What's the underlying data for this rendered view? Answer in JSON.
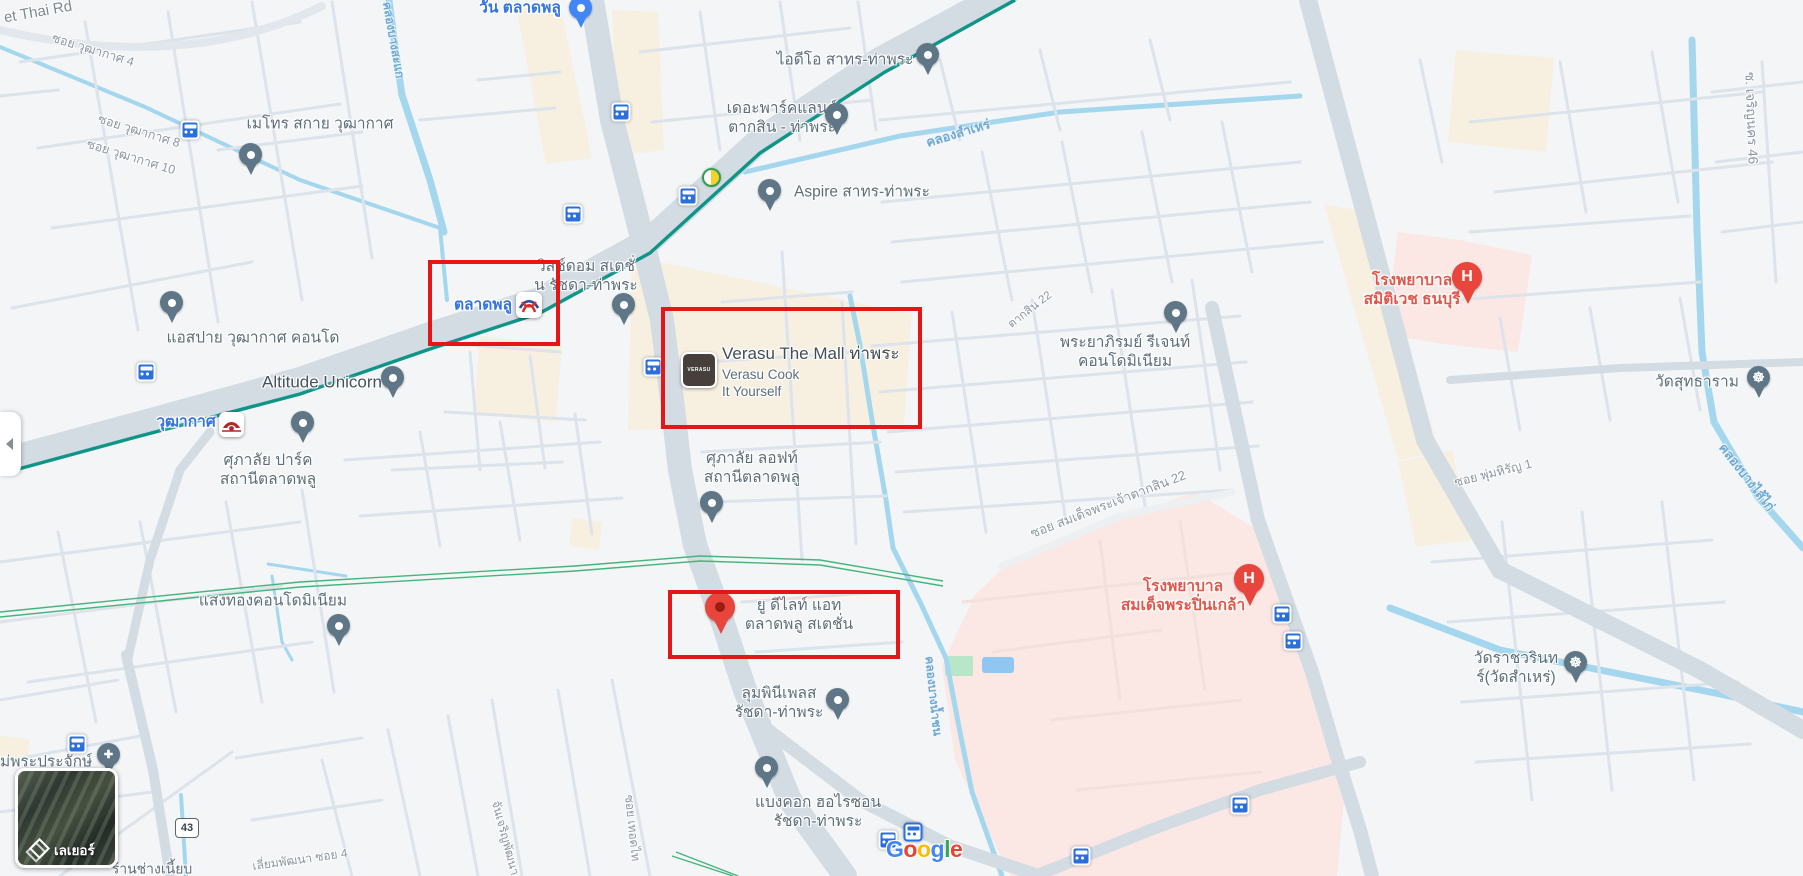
{
  "map": {
    "attribution": {
      "letters": [
        "G",
        "o",
        "o",
        "g",
        "l",
        "e"
      ]
    },
    "layers_panel": {
      "label": "เลเยอร์"
    },
    "route_shield": "43",
    "highlighted_areas": [
      "ตลาดพลู",
      "Verasu The Mall ท่าพระ",
      "ยู ดีไลท์ แอท ตลาดพลู สเตชั่น"
    ],
    "colors": {
      "transit_line": "#0f9488",
      "water": "#a4d7ee",
      "hospital_area": "#fbe7e4",
      "commercial_area": "#f7f0e1",
      "poi_blue": "#3473e0",
      "poi_red": "#e0574a",
      "annotation": "#e51616"
    }
  },
  "streets": {
    "thoet_thai": "et Thai Rd",
    "wutthakat4": "ซอย วุฒากาศ 4",
    "wutthakat8": "ซอย วุฒากาศ 8",
    "wutthakat10": "ซอย วุฒากาศ 10",
    "taksin22": "ตากสิน 22",
    "somdet_taksin22": "ซอย สมเด็จพระเจ้าตากสิน 22",
    "phum_hirun1": "ซอย พุ่มหิรัญ 1",
    "charoen_nakhon46": "ซ. เจริญนคร 46",
    "liam_phatthana": "เลี่ยมพัฒนา ซอย 4",
    "chan_charoen": "จันเจริญพัฒนา",
    "thoet_thai_soi": "ซอย เทอดไท"
  },
  "canals": {
    "samre": "คลองสำเหร่",
    "bang_sai_kai": "คลองบางไส้ไก่",
    "bang_sakae": "คลองบางสะแก",
    "bang_nam_chon": "คลองบางน้ำชน"
  },
  "pois": {
    "talat_phlu_station": "ตลาดพลู",
    "one_talat_phlu": "วัน ตลาดพลู",
    "wutthakat_station": "วุฒากาศ",
    "metro_sky": "เมโทร สกาย วุฒากาศ",
    "ideo": "ไอดีโอ สาทร-ท่าพระ",
    "parkland": "เดอะพาร์คแลนด์\nตากสิน - ท่าพระ",
    "aspire": "Aspire สาทร-ท่าพระ",
    "whizdom": "วิสซ์ดอม สเตชั่\nน รัชดา-ท่าพระ",
    "verasu": {
      "name": "Verasu The Mall ท่าพระ",
      "subtitle": "Verasu Cook\nIt Yourself",
      "logo": "VERASU"
    },
    "altitude_unicorn": "Altitude Unicorn",
    "aspai": "แอสปาย วุฒากาศ คอนโด",
    "supalai_park": "ศุภาลัย ปาร์ค\nสถานีตลาดพลู",
    "supalai_loft": "ศุภาลัย ลอฟท์\nสถานีตลาดพลู",
    "sangthong": "แสงทองคอนโดมิเนียม",
    "u_delight": "ยู ดีไลท์ แอท\nตลาดพลู สเตชั่น",
    "lumpini": "ลุมพินีเพลส\nรัชดา-ท่าพระ",
    "bangkok_horizon": "แบงคอก ฮอไรซอน\nรัชดา-ท่าพระ",
    "phraya_phirom": "พระยาภิรมย์ รีเจนท์\nคอนโดมิเนียม",
    "samitivej_hospital": "โรงพยาบาล\nสมิติเวช ธนบุรี",
    "pinklao_hospital": "โรงพยาบาล\nสมเด็จพระปิ่นเกล้า",
    "wat_suttharam": "วัดสุทธาราม",
    "wat_ratchawarin": "วัดราชวรินท\nร์(วัดสำเหร่)",
    "mae_phra_prachak": "ม่พระประจักษ์",
    "chang_shop": "ร้านช่างเนี้ยบ"
  },
  "icons": {
    "hospital_pin": "H",
    "temple_pin": "☸",
    "church_pin": "✚"
  }
}
